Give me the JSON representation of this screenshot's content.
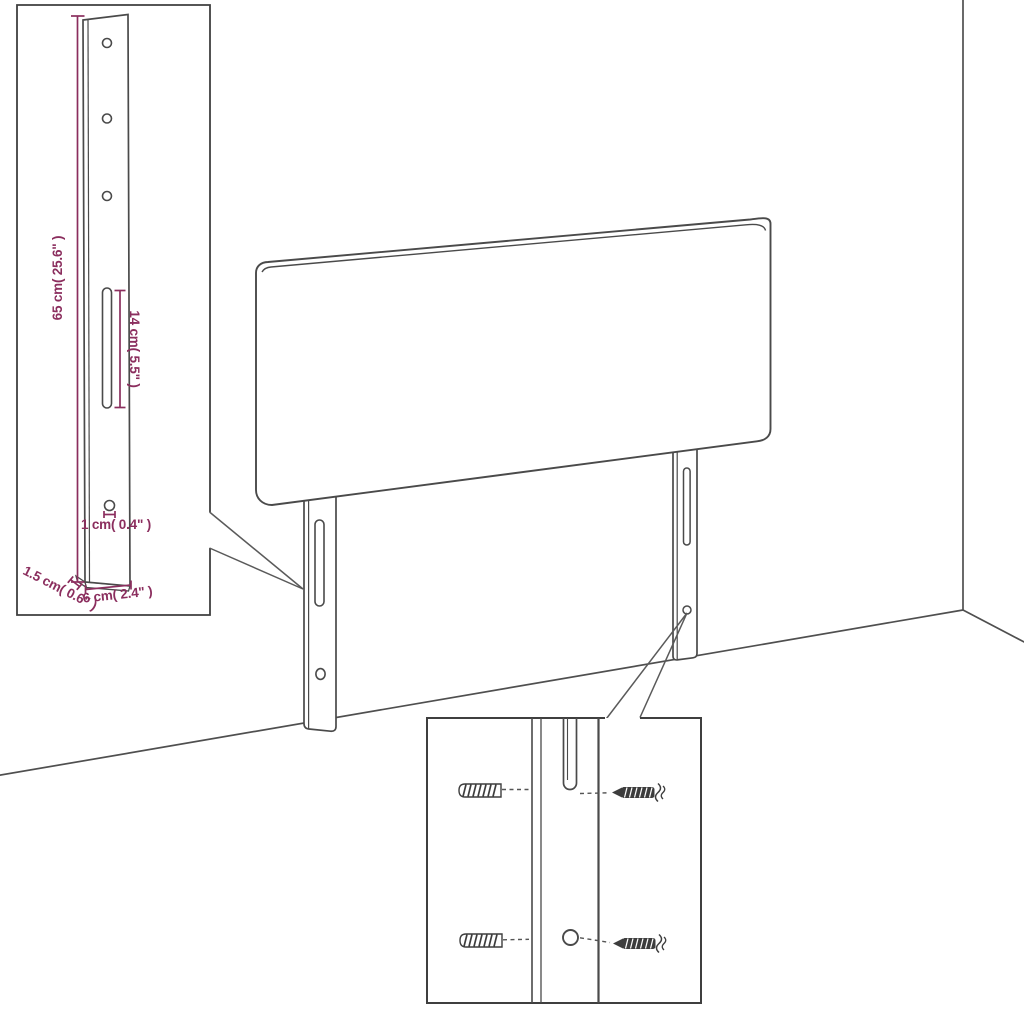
{
  "image": {
    "title": "Headboard mounting diagram",
    "background": "#ffffff"
  },
  "colors": {
    "outline": "#4a4a4a",
    "dimension": "#8b2e5e"
  },
  "scene": {
    "parts": [
      "headboard",
      "left mounting leg",
      "right mounting leg",
      "wall corner",
      "floor"
    ]
  },
  "leg_detail_inset": {
    "labels": {
      "height": "65 cm( 25.6\" )",
      "slot_length": "14 cm( 5.5\" )",
      "hole_diameter": "1 cm( 0.4\" )",
      "thickness": "1.5 cm( 0.6\" )",
      "width": "6 cm( 2.4\" )"
    },
    "features": [
      "three screw holes",
      "long adjustment slot",
      "lower fixing hole"
    ]
  },
  "hardware_detail_inset": {
    "parts": [
      "wall plug",
      "screw",
      "adjustment slot",
      "fixing hole"
    ]
  }
}
